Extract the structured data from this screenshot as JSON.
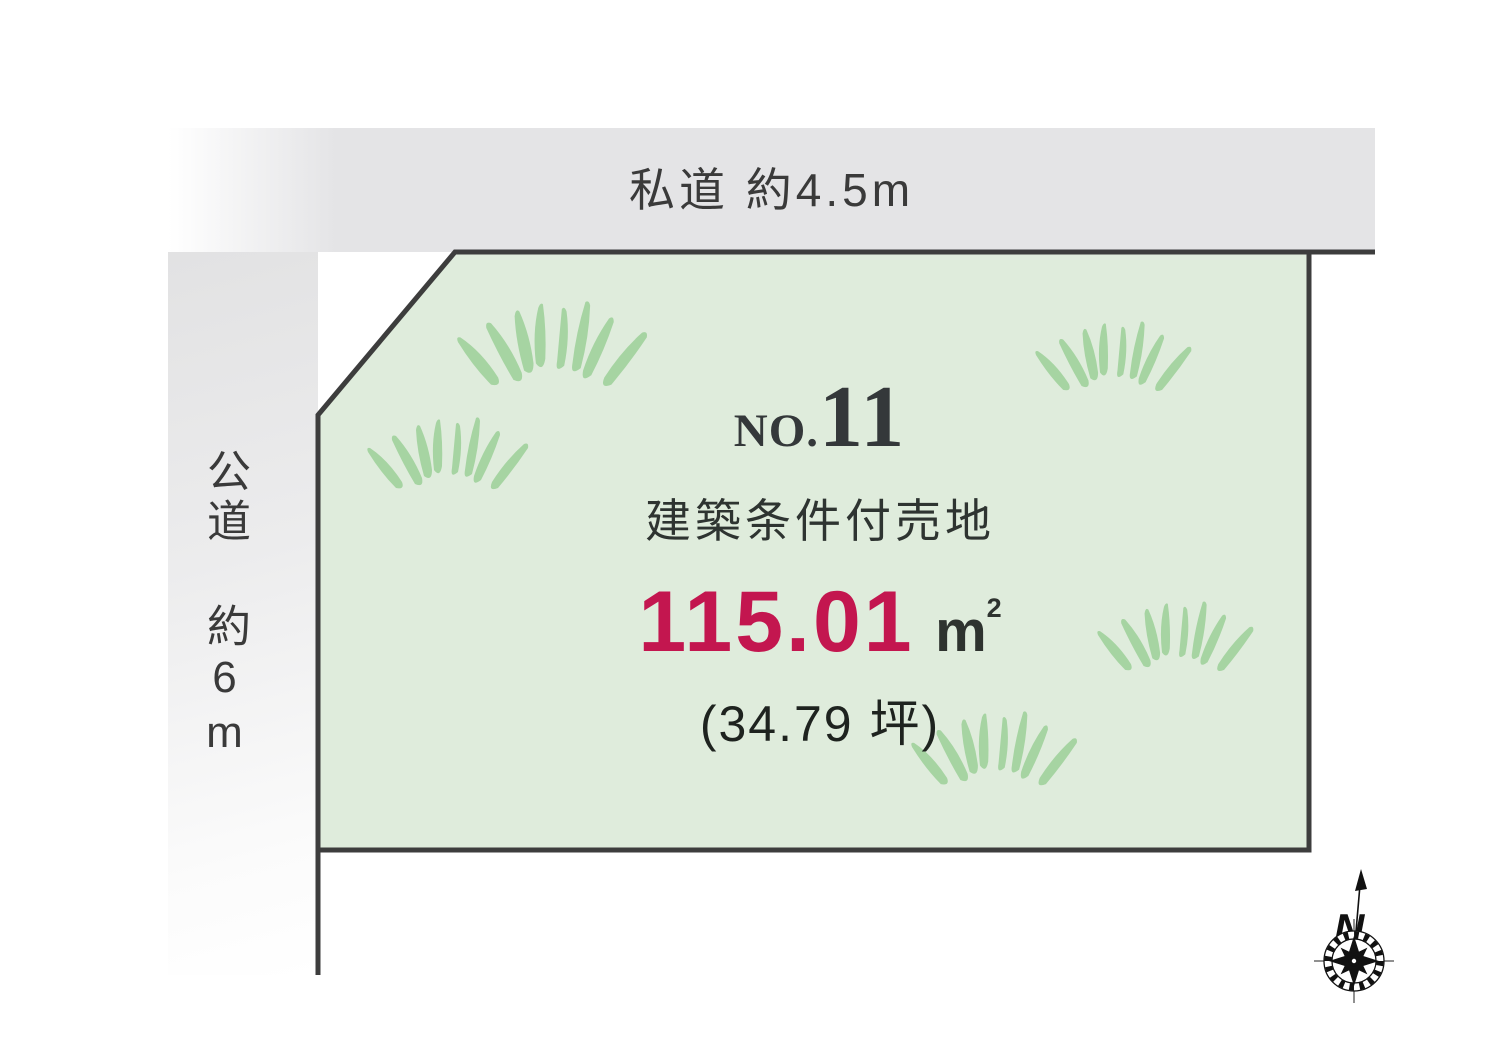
{
  "roads": {
    "top": {
      "label": "私道 約4.5m"
    },
    "left": {
      "label": "公道 約6m"
    }
  },
  "plot": {
    "number_prefix": "NO.",
    "number": "11",
    "category": "建築条件付売地",
    "area_sqm": "115.01",
    "area_unit_base": "m",
    "area_unit_exponent": "2",
    "area_tsubo": "(34.79 坪)"
  },
  "compass": {
    "label": "N"
  },
  "colors": {
    "plot_fill": "#dfecdc",
    "plot_border": "#3d3d3d",
    "road_fill": "#e4e4e6",
    "grass": "#a6d4a2",
    "area_accent": "#c3164f",
    "text_dark": "#34383a"
  }
}
